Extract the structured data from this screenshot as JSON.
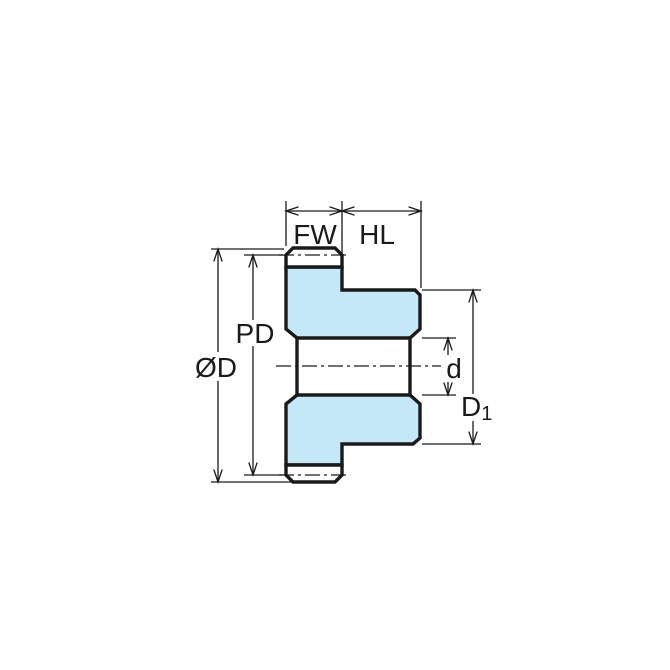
{
  "dims": {
    "fw": "FW",
    "hl": "HL",
    "pd": "PD",
    "od": "ØD",
    "bore": "d",
    "d1_main": "D",
    "d1_sub": "1"
  },
  "colors": {
    "part_fill": "#C5E8F8",
    "tooth_fill": "#FFFFFF",
    "line_color": "#1A1A1A",
    "background": "#FFFFFF"
  }
}
